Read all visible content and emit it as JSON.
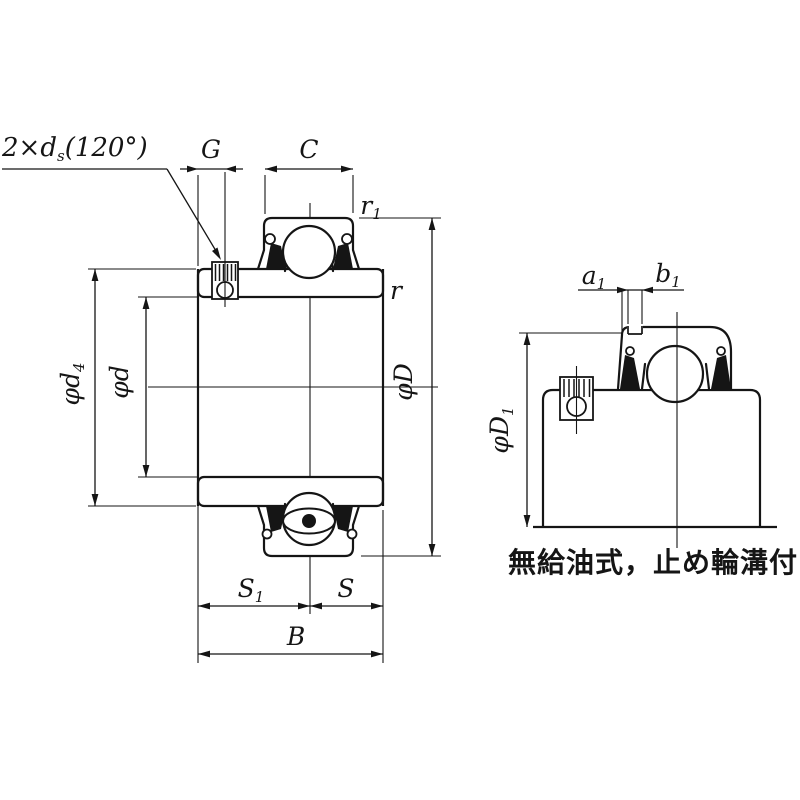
{
  "drawing": {
    "background": "#ffffff",
    "line_color": "#151515",
    "caption": "無給油式，止め輪溝付",
    "labels": {
      "set_screw_note": {
        "main": "2×d",
        "sub": "s",
        "tail": "(120°)"
      },
      "G": {
        "main": "G",
        "sub": ""
      },
      "C": {
        "main": "C",
        "sub": ""
      },
      "r1": {
        "main": "r",
        "sub": "1"
      },
      "r": {
        "main": "r",
        "sub": ""
      },
      "phi_D": {
        "main": "φD",
        "sub": ""
      },
      "phi_d": {
        "main": "φd",
        "sub": ""
      },
      "phi_d4": {
        "main": "φd",
        "sub": "4"
      },
      "S1": {
        "main": "S",
        "sub": "1"
      },
      "S": {
        "main": "S",
        "sub": ""
      },
      "B": {
        "main": "B",
        "sub": ""
      },
      "a1": {
        "main": "a",
        "sub": "1"
      },
      "b1": {
        "main": "b",
        "sub": "1"
      },
      "phi_D1": {
        "main": "φD",
        "sub": "1"
      }
    }
  }
}
